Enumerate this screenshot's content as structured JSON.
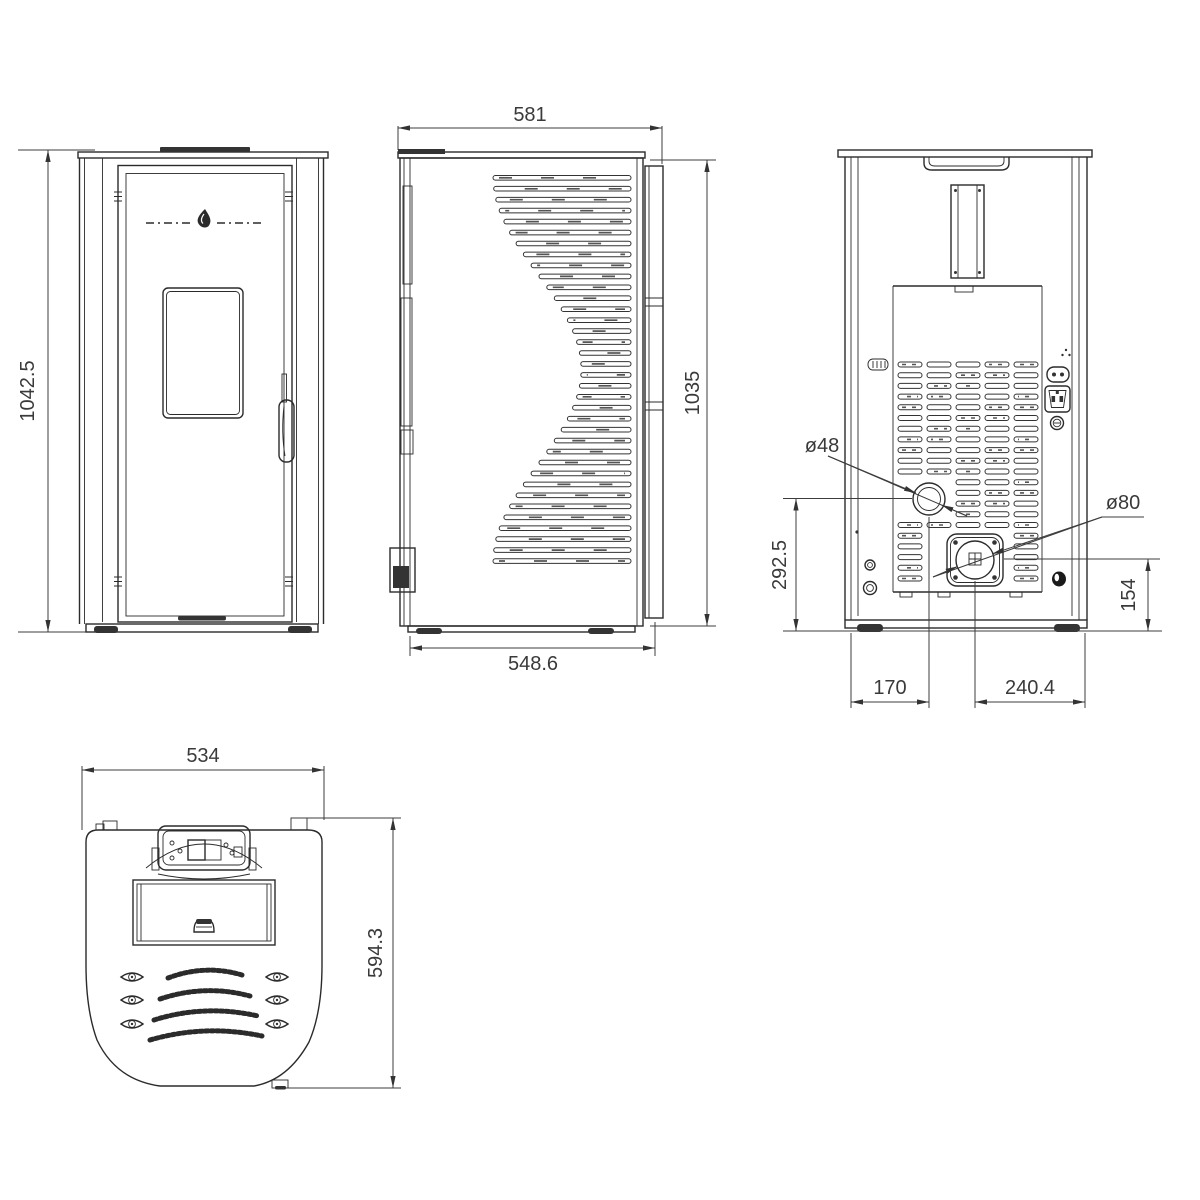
{
  "dimensions": {
    "front": {
      "height": "1042.5"
    },
    "side": {
      "width_top": "581",
      "height": "1035",
      "depth_bottom": "548.6"
    },
    "back": {
      "air_inlet_diameter": "ø48",
      "flue_diameter": "ø80",
      "air_inlet_height": "292.5",
      "flue_height": "154",
      "air_inlet_offset_x": "170",
      "flue_offset_x": "240.4"
    },
    "top": {
      "width": "534",
      "depth": "594.3"
    }
  }
}
